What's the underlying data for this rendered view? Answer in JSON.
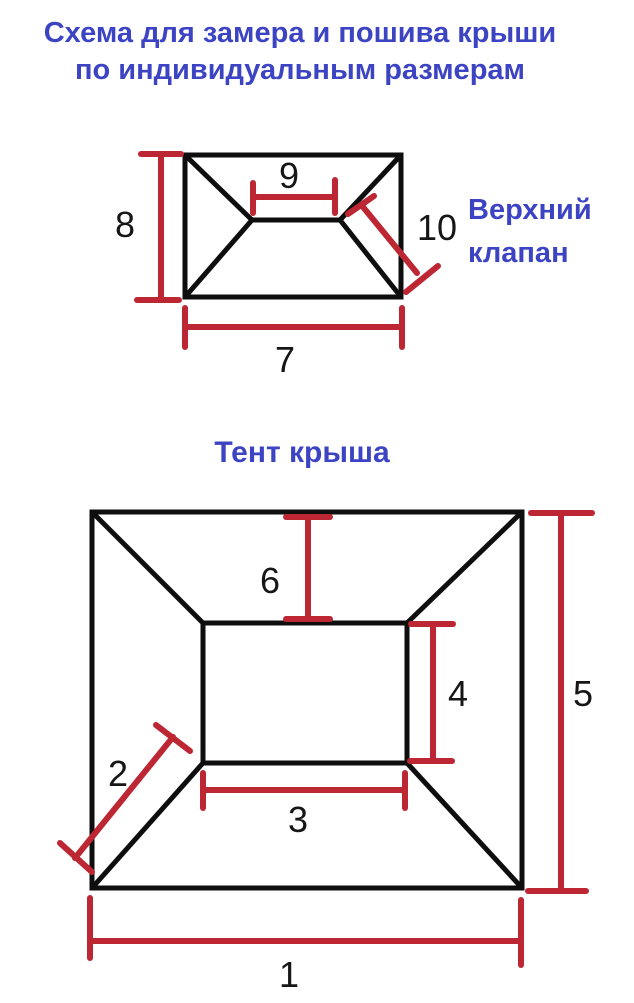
{
  "title": {
    "line1": "Схема для замера и пошива крыши",
    "line2": "по индивидуальным размерам"
  },
  "top_diagram": {
    "label": "Верхний клапан",
    "dims": {
      "height": "8",
      "ridge": "9",
      "slope": "10",
      "width": "7"
    }
  },
  "bottom_diagram": {
    "label": "Тент крыша",
    "dims": {
      "top_slope": "6",
      "inner_height": "4",
      "corner_slope": "2",
      "inner_width": "3",
      "outer_height": "5",
      "outer_width": "1"
    }
  },
  "colors": {
    "label_blue": "#3d44c3",
    "dimension_red": "#bd2733",
    "outline_black": "#0e0e0e"
  }
}
